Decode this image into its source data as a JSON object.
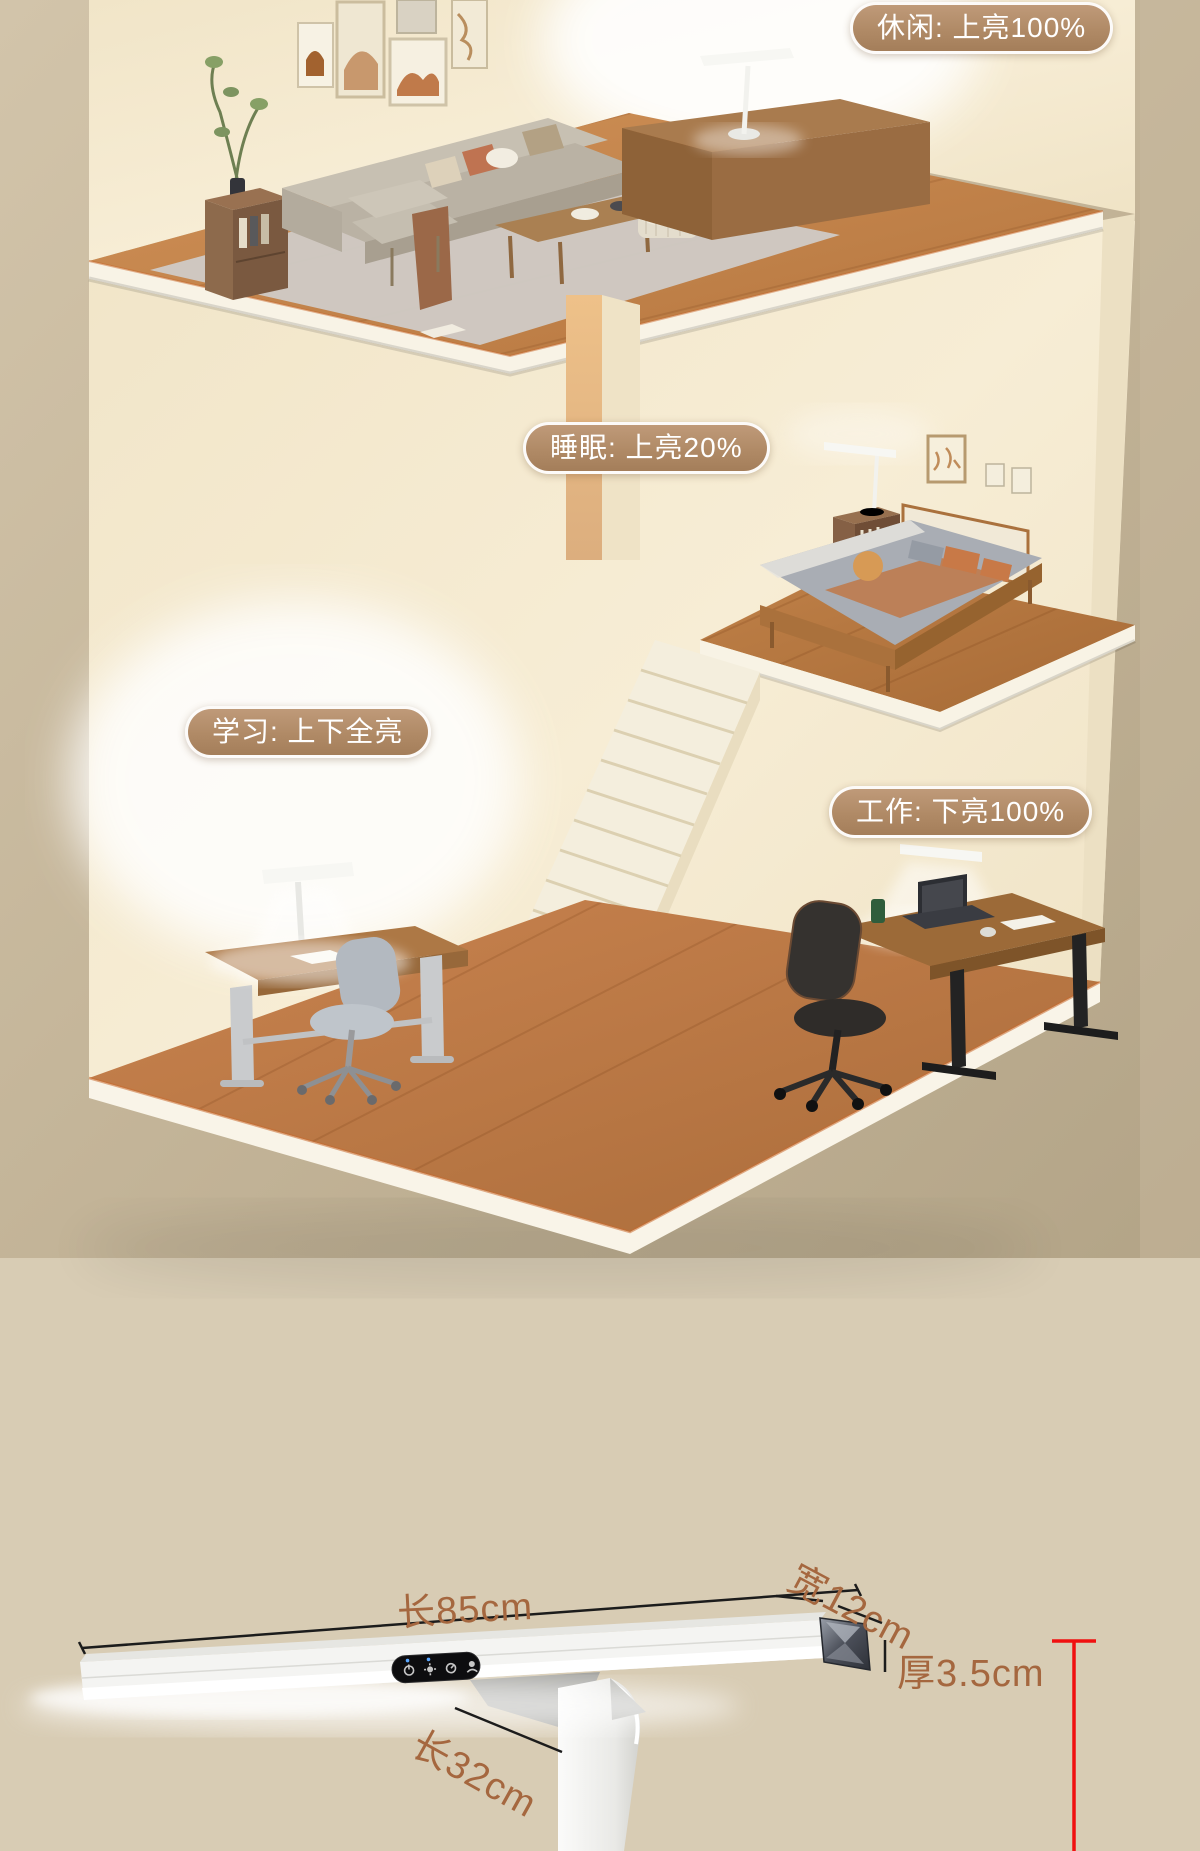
{
  "scene": {
    "mode_labels": [
      {
        "id": "leisure",
        "label": "休闲: 上亮100%"
      },
      {
        "id": "sleep",
        "label": "睡眠: 上亮20%"
      },
      {
        "id": "study",
        "label": "学习: 上下全亮"
      },
      {
        "id": "work",
        "label": "工作: 下亮100%"
      }
    ],
    "label_style": {
      "background": "#b08a66",
      "border": "#ffffff",
      "text": "#ffffff"
    }
  },
  "dimensions": {
    "bar_length": "长85cm",
    "bar_width": "宽12cm",
    "bar_thickness": "厚3.5cm",
    "arm_length": "长32cm",
    "label_color": "#a5673f",
    "line_color": "#1c1c1c",
    "height_marker_color": "#f01010"
  },
  "lamp": {
    "control_icons": [
      "power-icon",
      "brightness-icon",
      "timer-icon",
      "gesture-icon"
    ]
  }
}
